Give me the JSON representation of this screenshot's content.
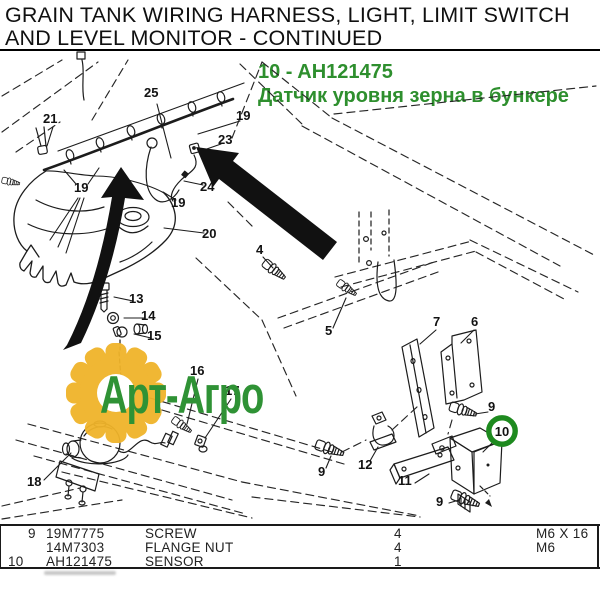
{
  "header": {
    "title_line1": "GRAIN TANK WIRING HARNESS, LIGHT, LIMIT SWITCH",
    "title_line2": "AND LEVEL MONITOR - CONTINUED"
  },
  "part_callout_heading": {
    "code_line": "10 - AH121475",
    "description_line": "Датчик уровня зерна в бункере",
    "color": "#2e8f2e"
  },
  "watermark": {
    "text": "Арт-Агро",
    "gear_color": "#f0b42a",
    "text_color": "#2f9235"
  },
  "diagram": {
    "highlight": {
      "label": "10",
      "ring_color": "#1e8a1f"
    },
    "callouts": [
      {
        "label": "21"
      },
      {
        "label": "25"
      },
      {
        "label": "19"
      },
      {
        "label": "23"
      },
      {
        "label": "19"
      },
      {
        "label": "24"
      },
      {
        "label": "19"
      },
      {
        "label": "20"
      },
      {
        "label": "13"
      },
      {
        "label": "14"
      },
      {
        "label": "15"
      },
      {
        "label": "4"
      },
      {
        "label": "5"
      },
      {
        "label": "16"
      },
      {
        "label": "17"
      },
      {
        "label": "18"
      },
      {
        "label": "7"
      },
      {
        "label": "6"
      },
      {
        "label": "9"
      },
      {
        "label": "11"
      },
      {
        "label": "12"
      },
      {
        "label": "9"
      },
      {
        "label": "9"
      }
    ]
  },
  "table": {
    "rows": [
      {
        "ref": "9",
        "part_number": "19M7775",
        "description": "SCREW",
        "qty": "4",
        "remarks": "M6 X 16"
      },
      {
        "ref": "",
        "part_number": "14M7303",
        "description": "FLANGE NUT",
        "qty": "4",
        "remarks": "M6"
      },
      {
        "ref": "10",
        "part_number": "AH121475",
        "description": "SENSOR",
        "qty": "1",
        "remarks": ""
      }
    ]
  }
}
